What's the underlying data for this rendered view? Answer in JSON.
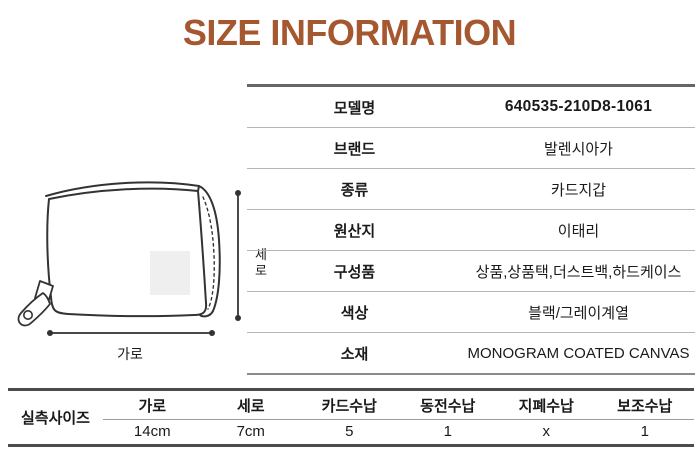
{
  "title": "SIZE INFORMATION",
  "colors": {
    "title": "#a5572f",
    "table_border_dark": "#4c4c4c",
    "table_border_medium": "#8a8a8a",
    "row_separator": "#b5b5b5",
    "text": "#1a1a1a",
    "sketch_line": "#333333"
  },
  "diagram": {
    "sketch": "zip-around-card-wallet",
    "width_label": "가로",
    "height_label": "세로"
  },
  "spec_table": {
    "rows": [
      {
        "label": "모델명",
        "value": "640535-210D8-1061"
      },
      {
        "label": "브랜드",
        "value": "발렌시아가"
      },
      {
        "label": "종류",
        "value": "카드지갑"
      },
      {
        "label": "원산지",
        "value": "이태리"
      },
      {
        "label": "구성품",
        "value": "상품,상품택,더스트백,하드케이스"
      },
      {
        "label": "색상",
        "value": "블랙/그레이계열"
      },
      {
        "label": "소재",
        "value": "MONOGRAM COATED CANVAS"
      }
    ]
  },
  "size_table": {
    "row_label": "실측사이즈",
    "columns": [
      "가로",
      "세로",
      "카드수납",
      "동전수납",
      "지폐수납",
      "보조수납"
    ],
    "values": [
      "14cm",
      "7cm",
      "5",
      "1",
      "x",
      "1"
    ]
  }
}
